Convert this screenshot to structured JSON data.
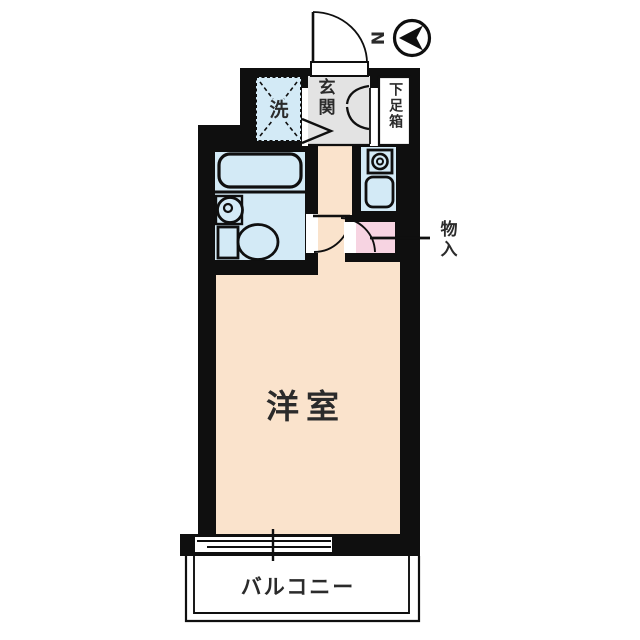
{
  "title": "apartment-floor-plan",
  "compass": {
    "north_label": "N"
  },
  "rooms": {
    "main_room": {
      "label": "洋室"
    },
    "balcony": {
      "label": "バルコニー"
    },
    "entrance": {
      "label": "玄関"
    },
    "shoe_box": {
      "label": "下足箱"
    },
    "washer": {
      "label": "洗"
    },
    "storage": {
      "label": "物入"
    }
  },
  "colors": {
    "wall": "#0f0f0f",
    "room-fill": "#FAE3CC",
    "wet-fill": "#D3EAF6",
    "entrance-fill": "#E3E3E3",
    "storage-fill": "#F7D4E2",
    "text": "#2b2b2b",
    "background": "#ffffff"
  }
}
